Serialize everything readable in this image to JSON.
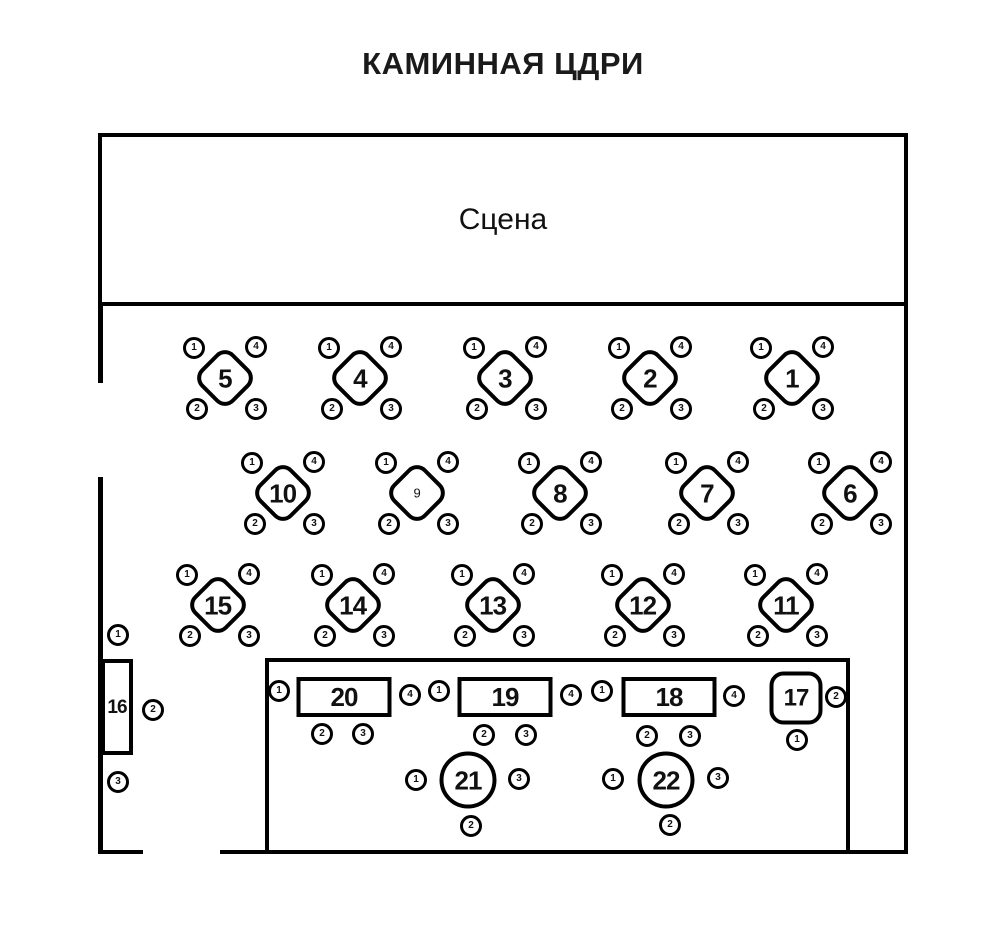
{
  "title": "КАМИННАЯ ЦДРИ",
  "stage": {
    "label": "Сцена"
  },
  "colors": {
    "line": "#000000",
    "background": "#ffffff"
  },
  "tables": [
    {
      "number": "5",
      "shape": "diamond",
      "cx": 225,
      "cy": 378,
      "seats": [
        [
          "1",
          -31,
          -30
        ],
        [
          "4",
          31,
          -31
        ],
        [
          "2",
          -28,
          31
        ],
        [
          "3",
          31,
          31
        ]
      ]
    },
    {
      "number": "4",
      "shape": "diamond",
      "cx": 360,
      "cy": 378,
      "seats": [
        [
          "1",
          -31,
          -30
        ],
        [
          "4",
          31,
          -31
        ],
        [
          "2",
          -28,
          31
        ],
        [
          "3",
          31,
          31
        ]
      ]
    },
    {
      "number": "3",
      "shape": "diamond",
      "cx": 505,
      "cy": 378,
      "seats": [
        [
          "1",
          -31,
          -30
        ],
        [
          "4",
          31,
          -31
        ],
        [
          "2",
          -28,
          31
        ],
        [
          "3",
          31,
          31
        ]
      ]
    },
    {
      "number": "2",
      "shape": "diamond",
      "cx": 650,
      "cy": 378,
      "seats": [
        [
          "1",
          -31,
          -30
        ],
        [
          "4",
          31,
          -31
        ],
        [
          "2",
          -28,
          31
        ],
        [
          "3",
          31,
          31
        ]
      ]
    },
    {
      "number": "1",
      "shape": "diamond",
      "cx": 792,
      "cy": 378,
      "seats": [
        [
          "1",
          -31,
          -30
        ],
        [
          "4",
          31,
          -31
        ],
        [
          "2",
          -28,
          31
        ],
        [
          "3",
          31,
          31
        ]
      ]
    },
    {
      "number": "10",
      "shape": "diamond",
      "cx": 283,
      "cy": 493,
      "seats": [
        [
          "1",
          -31,
          -30
        ],
        [
          "4",
          31,
          -31
        ],
        [
          "2",
          -28,
          31
        ],
        [
          "3",
          31,
          31
        ]
      ]
    },
    {
      "number": "9",
      "shape": "diamond",
      "cx": 417,
      "cy": 493,
      "small": true,
      "seats": [
        [
          "1",
          -31,
          -30
        ],
        [
          "4",
          31,
          -31
        ],
        [
          "2",
          -28,
          31
        ],
        [
          "3",
          31,
          31
        ]
      ]
    },
    {
      "number": "8",
      "shape": "diamond",
      "cx": 560,
      "cy": 493,
      "seats": [
        [
          "1",
          -31,
          -30
        ],
        [
          "4",
          31,
          -31
        ],
        [
          "2",
          -28,
          31
        ],
        [
          "3",
          31,
          31
        ]
      ]
    },
    {
      "number": "7",
      "shape": "diamond",
      "cx": 707,
      "cy": 493,
      "seats": [
        [
          "1",
          -31,
          -30
        ],
        [
          "4",
          31,
          -31
        ],
        [
          "2",
          -28,
          31
        ],
        [
          "3",
          31,
          31
        ]
      ]
    },
    {
      "number": "6",
      "shape": "diamond",
      "cx": 850,
      "cy": 493,
      "seats": [
        [
          "1",
          -31,
          -30
        ],
        [
          "4",
          31,
          -31
        ],
        [
          "2",
          -28,
          31
        ],
        [
          "3",
          31,
          31
        ]
      ]
    },
    {
      "number": "15",
      "shape": "diamond",
      "cx": 218,
      "cy": 605,
      "seats": [
        [
          "1",
          -31,
          -30
        ],
        [
          "4",
          31,
          -31
        ],
        [
          "2",
          -28,
          31
        ],
        [
          "3",
          31,
          31
        ]
      ]
    },
    {
      "number": "14",
      "shape": "diamond",
      "cx": 353,
      "cy": 605,
      "seats": [
        [
          "1",
          -31,
          -30
        ],
        [
          "4",
          31,
          -31
        ],
        [
          "2",
          -28,
          31
        ],
        [
          "3",
          31,
          31
        ]
      ]
    },
    {
      "number": "13",
      "shape": "diamond",
      "cx": 493,
      "cy": 605,
      "seats": [
        [
          "1",
          -31,
          -30
        ],
        [
          "4",
          31,
          -31
        ],
        [
          "2",
          -28,
          31
        ],
        [
          "3",
          31,
          31
        ]
      ]
    },
    {
      "number": "12",
      "shape": "diamond",
      "cx": 643,
      "cy": 605,
      "seats": [
        [
          "1",
          -31,
          -30
        ],
        [
          "4",
          31,
          -31
        ],
        [
          "2",
          -28,
          31
        ],
        [
          "3",
          31,
          31
        ]
      ]
    },
    {
      "number": "11",
      "shape": "diamond",
      "cx": 786,
      "cy": 605,
      "seats": [
        [
          "1",
          -31,
          -30
        ],
        [
          "4",
          31,
          -31
        ],
        [
          "2",
          -28,
          31
        ],
        [
          "3",
          31,
          31
        ]
      ]
    },
    {
      "number": "16",
      "shape": "vrect",
      "cx": 117,
      "cy": 707,
      "seats": [
        [
          "1",
          1,
          -72
        ],
        [
          "2",
          36,
          3
        ],
        [
          "3",
          1,
          75
        ]
      ]
    },
    {
      "number": "20",
      "shape": "hrect",
      "cx": 344,
      "cy": 697,
      "seats": [
        [
          "1",
          -65,
          -6
        ],
        [
          "4",
          66,
          -2
        ],
        [
          "2",
          -22,
          37
        ],
        [
          "3",
          19,
          37
        ]
      ]
    },
    {
      "number": "19",
      "shape": "hrect",
      "cx": 505,
      "cy": 697,
      "seats": [
        [
          "1",
          -66,
          -6
        ],
        [
          "4",
          66,
          -2
        ],
        [
          "2",
          -21,
          38
        ],
        [
          "3",
          21,
          38
        ]
      ]
    },
    {
      "number": "18",
      "shape": "hrect",
      "cx": 669,
      "cy": 697,
      "seats": [
        [
          "1",
          -67,
          -6
        ],
        [
          "4",
          65,
          -1
        ],
        [
          "2",
          -22,
          39
        ],
        [
          "3",
          21,
          39
        ]
      ]
    },
    {
      "number": "17",
      "shape": "rsquare",
      "cx": 796,
      "cy": 698,
      "seats": [
        [
          "2",
          40,
          -1
        ],
        [
          "1",
          1,
          42
        ]
      ]
    },
    {
      "number": "21",
      "shape": "circle",
      "cx": 468,
      "cy": 780,
      "seats": [
        [
          "1",
          -52,
          0
        ],
        [
          "3",
          51,
          -1
        ],
        [
          "2",
          3,
          46
        ]
      ]
    },
    {
      "number": "22",
      "shape": "circle",
      "cx": 666,
      "cy": 780,
      "seats": [
        [
          "1",
          -53,
          -1
        ],
        [
          "3",
          52,
          -2
        ],
        [
          "2",
          4,
          45
        ]
      ]
    }
  ]
}
